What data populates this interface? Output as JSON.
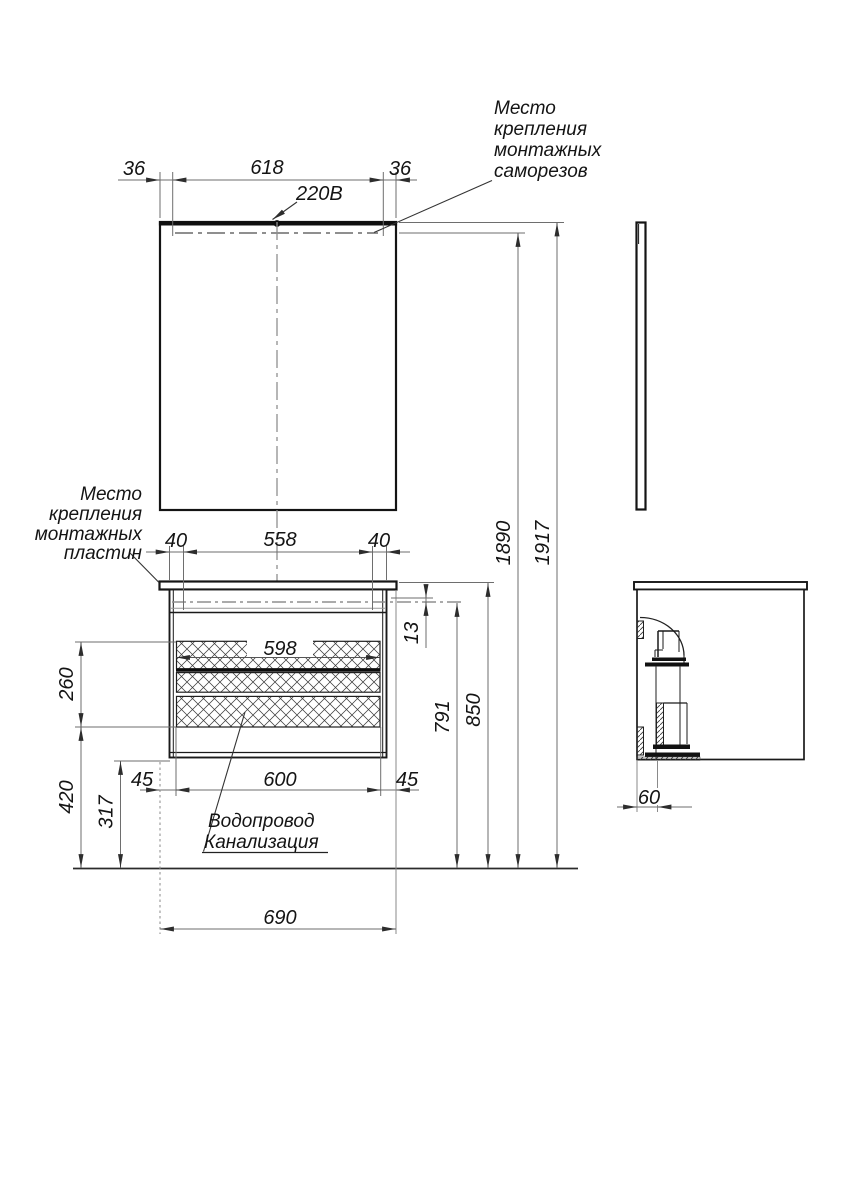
{
  "annotations": {
    "screws_note": {
      "line1": "Место",
      "line2": "крепления",
      "line3": "монтажных",
      "line4": "саморезов"
    },
    "plates_note": {
      "line1": "Место",
      "line2": "крепления",
      "line3": "монтажных",
      "line4": "пластин"
    },
    "plumbing_note": {
      "line1": "Водопровод",
      "line2": "Канализация"
    },
    "power_label": "220В"
  },
  "dimensions": {
    "mirror_offset_left": "36",
    "mirror_screw_span": "618",
    "mirror_offset_right": "36",
    "plate_offset_left": "40",
    "plate_span": "558",
    "plate_offset_right": "40",
    "drawer_inner_width": "598",
    "hatch_height": "260",
    "clearance_height": "420",
    "floor_to_cabinet": "317",
    "front_offset_left": "45",
    "front_width": "600",
    "front_offset_right": "45",
    "cabinet_width": "690",
    "plate_drop": "13",
    "carcass_top_height": "791",
    "counter_height": "850",
    "mount_height": "1890",
    "total_height": "1917",
    "wall_offset": "60"
  },
  "colors": {
    "object_line": "#1a1a1a",
    "dim_line": "#6e6e6e",
    "centerline": "#8f8f8f",
    "background": "#ffffff"
  }
}
